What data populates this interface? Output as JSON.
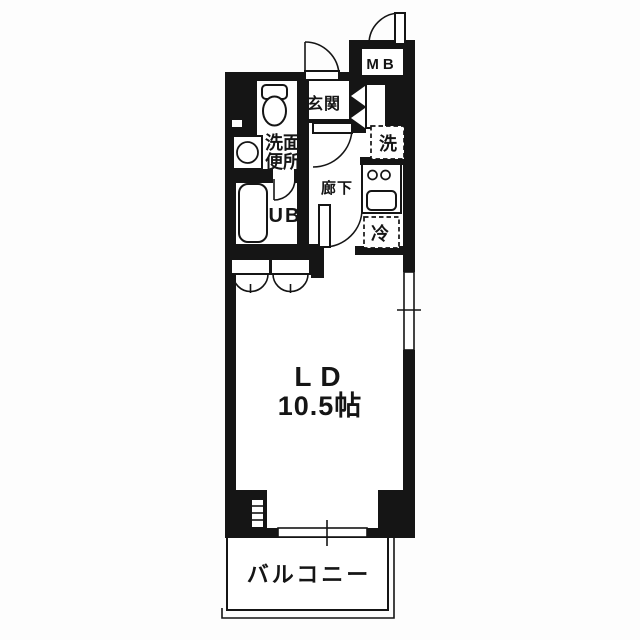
{
  "plan": {
    "type": "apartment-floor-plan",
    "colors": {
      "wall": "#151515",
      "floor": "#ffffff",
      "background": "#fdfdfd"
    },
    "labels": {
      "meter_box": "MB",
      "entrance": "玄関",
      "washroom_line1": "洗面",
      "washroom_line2": "便所",
      "unit_bath": "UB",
      "hallway": "廊下",
      "washer": "洗",
      "refrigerator": "冷",
      "living_dining": "LD",
      "living_dining_area": "10.5帖",
      "balcony": "バルコニー"
    }
  }
}
